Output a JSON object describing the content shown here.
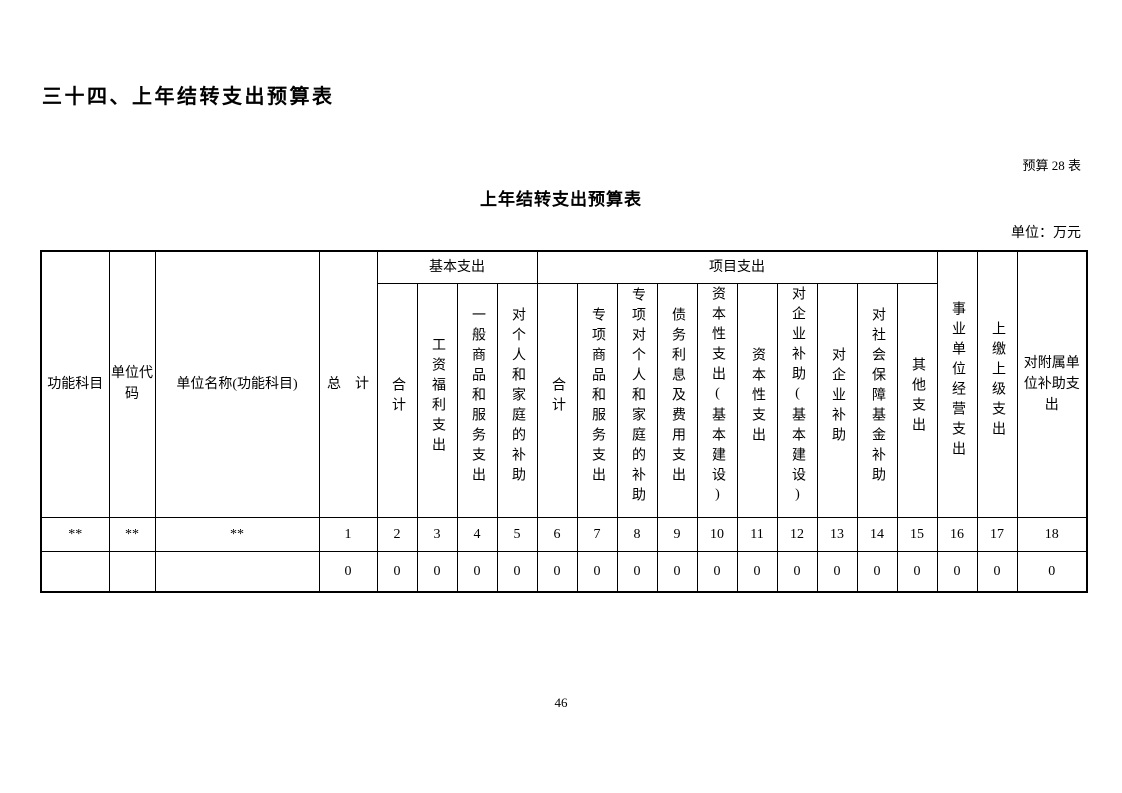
{
  "page": {
    "heading": "三十四、上年结转支出预算表",
    "table_label": "预算 28 表",
    "title": "上年结转支出预算表",
    "unit_label": "单位：万元",
    "page_number": "46"
  },
  "table": {
    "left_headers": [
      "功能科目",
      "单位代码",
      "单位名称(功能科目)",
      "总　计"
    ],
    "groups": [
      {
        "label": "基本支出",
        "columns": [
          "合计",
          "工资福利支出",
          "一般商品和服务支出",
          "对个人和家庭的补助"
        ]
      },
      {
        "label": "项目支出",
        "columns": [
          "合计",
          "专项商品和服务支出",
          "专项对个人和家庭的补助",
          "债务利息及费用支出",
          "资本性支出(基本建设)",
          "资本性支出",
          "对企业补助(基本建设)",
          "对企业补助",
          "对社会保障基金补助",
          "其他支出"
        ]
      }
    ],
    "right_headers": [
      "事业单位经营支出",
      "上缴上级支出",
      "对附属单位补助支出"
    ],
    "numbering_row": [
      "**",
      "**",
      "**",
      "1",
      "2",
      "3",
      "4",
      "5",
      "6",
      "7",
      "8",
      "9",
      "10",
      "11",
      "12",
      "13",
      "14",
      "15",
      "16",
      "17",
      "18"
    ],
    "data_row": [
      "",
      "",
      "",
      "0",
      "0",
      "0",
      "0",
      "0",
      "0",
      "0",
      "0",
      "0",
      "0",
      "0",
      "0",
      "0",
      "0",
      "0",
      "0",
      "0",
      "0"
    ]
  }
}
